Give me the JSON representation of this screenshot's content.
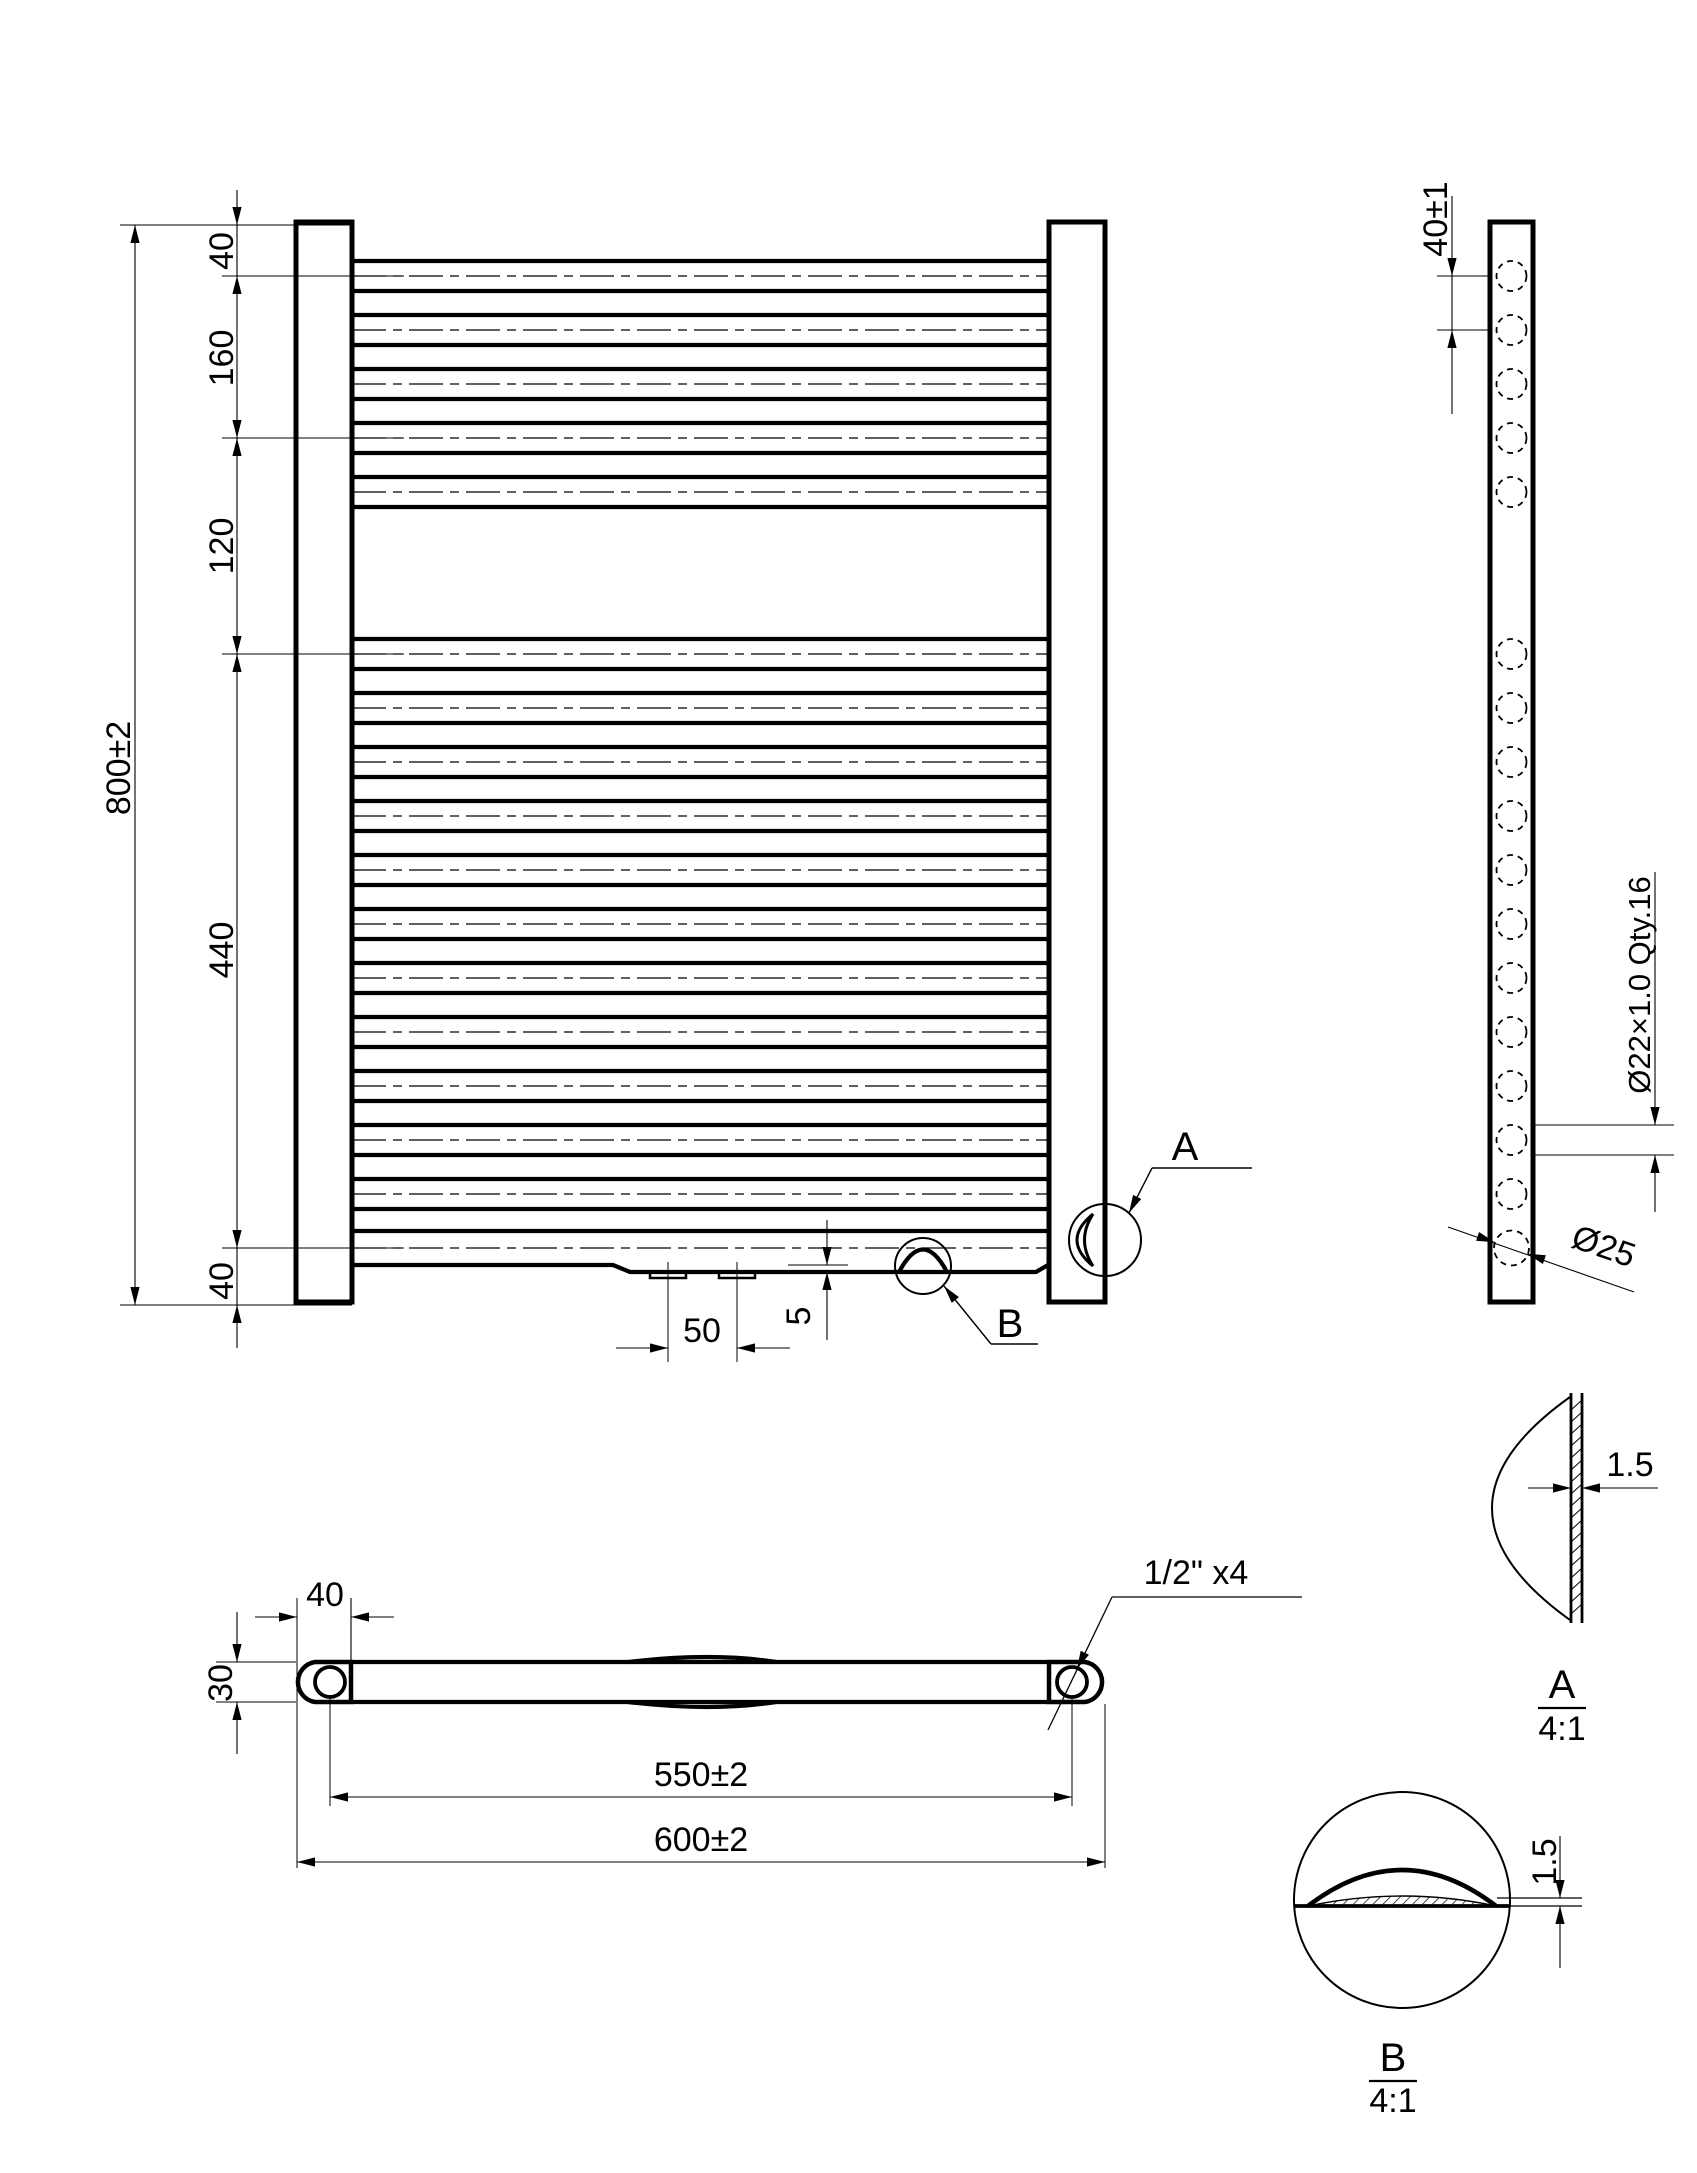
{
  "colors": {
    "ink": "#000000",
    "paper": "#ffffff"
  },
  "front_view": {
    "dim_overall_height": "800±2",
    "dim_top_offset": "40",
    "dim_upper_group_span": "160",
    "dim_middle_gap": "120",
    "dim_lower_group_span": "440",
    "dim_bottom_offset": "40",
    "dim_slot_spacing": "50",
    "dim_dome_height": "5",
    "callout_a": "A",
    "callout_b": "B"
  },
  "side_view": {
    "dim_tube_pitch": "40±1",
    "dim_tube_spec": "Ø22×1.0 Qty.16",
    "dim_collector_diameter": "Ø25"
  },
  "top_view": {
    "dim_end_width": "40",
    "dim_profile_depth": "30",
    "dim_port_centers": "550±2",
    "dim_overall_width": "600±2",
    "thread_callout": "1/2\" x4"
  },
  "detail_a": {
    "label": "A",
    "scale": "4:1",
    "dim_wall": "1.5"
  },
  "detail_b": {
    "label": "B",
    "scale": "4:1",
    "dim_wall": "1.5"
  }
}
